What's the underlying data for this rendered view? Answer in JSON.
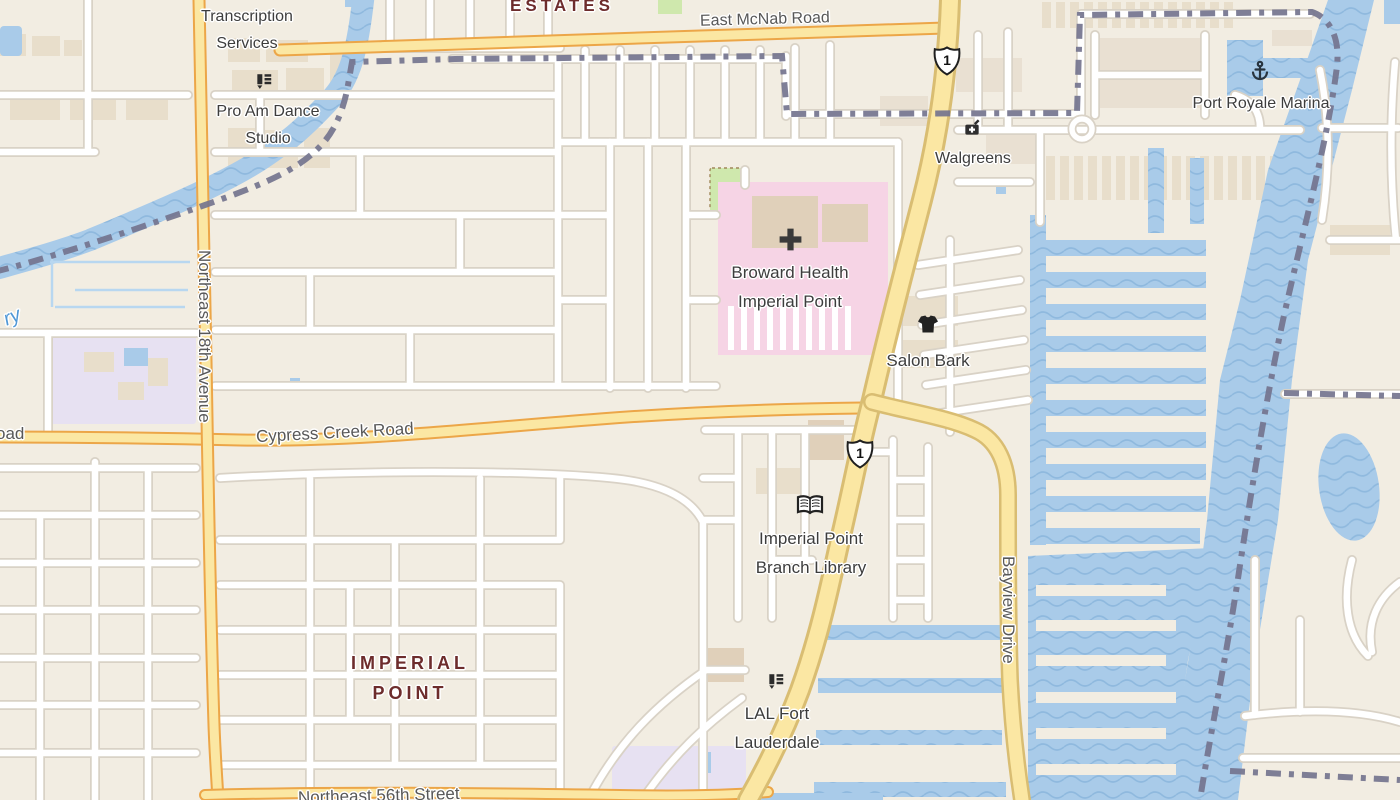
{
  "theme": {
    "land": "#f2ede2",
    "water": "#a9cbe9",
    "water_wave": "#8fb9de",
    "street_fill": "#ffffff",
    "street_casing": "#d9d2c6",
    "highway_fill": "#fbe7a3",
    "arterial_casing": "#eca648",
    "highway_casing": "#d9bd72",
    "boundary": "#74748e",
    "hospital_area": "#f6d4e5",
    "school_area": "#e7e1f2",
    "park_area": "#cfe8ad",
    "building": "#e8decb",
    "poi_label": "#3d3d3d",
    "road_label": "#585858",
    "place_label": "#6d2c2c",
    "water_label": "#4f97d6"
  },
  "labels": {
    "estates": "ESTATES",
    "east_mcnab_road": "East McNab Road",
    "transcription_services": {
      "line1": "Transcription",
      "line2": "Services"
    },
    "pro_am": {
      "line1": "Pro Am Dance",
      "line2": "Studio"
    },
    "port_royale_marina": "Port Royale Marina",
    "walgreens": "Walgreens",
    "broward_health": {
      "line1": "Broward Health",
      "line2": "Imperial Point"
    },
    "salon_bark": "Salon Bark",
    "cypress_creek_road": "Cypress Creek Road",
    "northeast_18th_avenue": "Northeast 18th Avenue",
    "library": {
      "line1": "Imperial Point",
      "line2": "Branch Library"
    },
    "imperial_point": {
      "line1": "IMPERIAL",
      "line2": "POINT"
    },
    "lal": {
      "line1": "LAL Fort",
      "line2": "Lauderdale"
    },
    "bayview_drive": "Bayview Drive",
    "northeast_56th_street": "Northeast 56th Street",
    "water_partial": "ry",
    "road_partial_west": "oad"
  },
  "shields": {
    "us1_north": "1",
    "us1_south": "1"
  }
}
